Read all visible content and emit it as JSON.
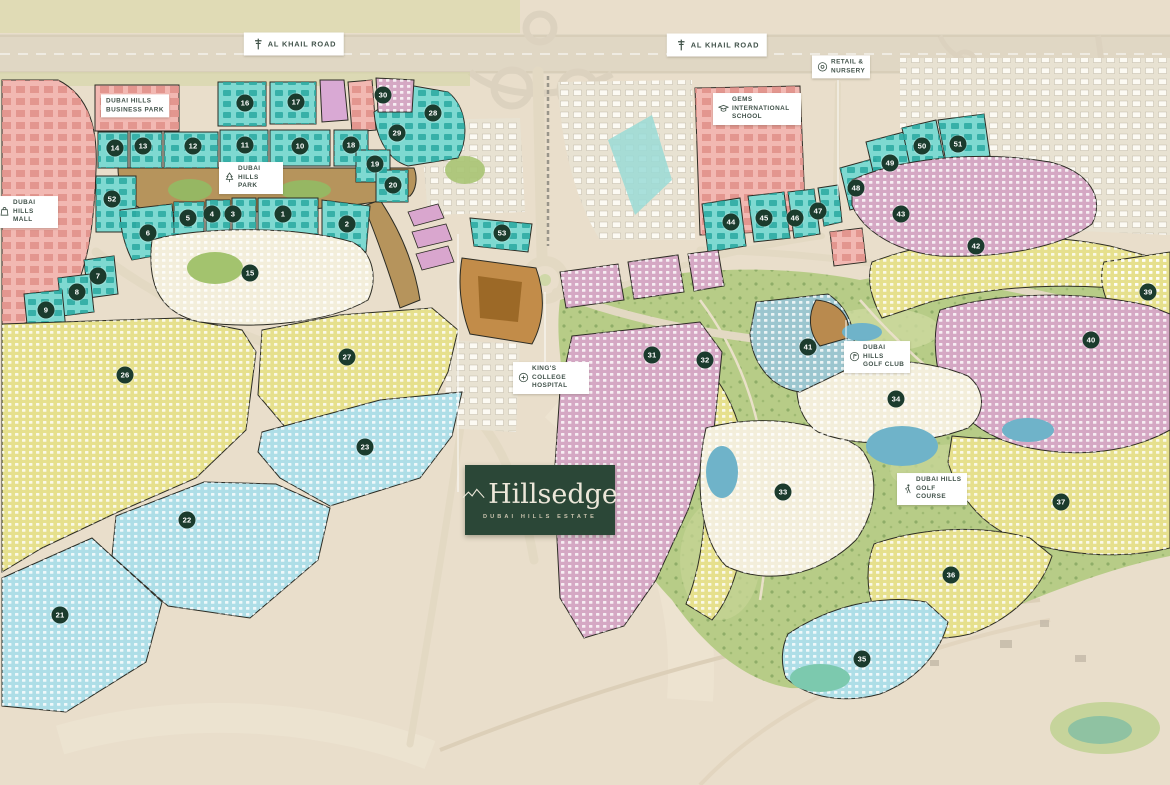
{
  "brand": {
    "name": "Hillsedge",
    "subtitle": "DUBAI HILLS ESTATE"
  },
  "labels": [
    {
      "id": "al-khail-road-west",
      "text": "AL KHAIL ROAD",
      "icon": "road-sign-icon",
      "x": 294,
      "y": 44,
      "big": true
    },
    {
      "id": "al-khail-road-east",
      "text": "AL KHAIL ROAD",
      "icon": "road-sign-icon",
      "x": 717,
      "y": 45,
      "big": true
    },
    {
      "id": "dubai-hills-business-park",
      "text": "DUBAI HILLS BUSINESS PARK",
      "icon": null,
      "x": 135,
      "y": 106,
      "w": 58
    },
    {
      "id": "dubai-hills-mall",
      "text": "DUBAI HILLS MALL",
      "icon": "shopping-bag-icon",
      "x": 26,
      "y": 212,
      "w": 40
    },
    {
      "id": "dubai-hills-park",
      "text": "DUBAI HILLS PARK",
      "icon": "tree-icon",
      "x": 251,
      "y": 178,
      "w": 40
    },
    {
      "id": "gems-international-school",
      "text": "GEMS INTERNATIONAL SCHOOL",
      "icon": "graduation-cap-icon",
      "x": 757,
      "y": 109,
      "w": 64
    },
    {
      "id": "retail-nursery",
      "text": "RETAIL & NURSERY",
      "icon": "retail-icon",
      "x": 841,
      "y": 67,
      "w": 34
    },
    {
      "id": "kings-college-hospital",
      "text": "KING'S COLLEGE HOSPITAL",
      "icon": "medical-cross-icon",
      "x": 551,
      "y": 378,
      "w": 52
    },
    {
      "id": "dubai-hills-golf-club",
      "text": "DUBAI HILLS GOLF CLUB",
      "icon": "golf-flag-icon",
      "x": 877,
      "y": 357,
      "w": 42
    },
    {
      "id": "dubai-hills-golf-course",
      "text": "DUBAI HILLS GOLF COURSE",
      "icon": "golfer-icon",
      "x": 932,
      "y": 489,
      "w": 46
    }
  ],
  "plot_markers": [
    {
      "number": "1",
      "x": 283,
      "y": 214
    },
    {
      "number": "2",
      "x": 347,
      "y": 224
    },
    {
      "number": "3",
      "x": 233,
      "y": 214
    },
    {
      "number": "4",
      "x": 212,
      "y": 214
    },
    {
      "number": "5",
      "x": 188,
      "y": 218
    },
    {
      "number": "6",
      "x": 148,
      "y": 233
    },
    {
      "number": "7",
      "x": 98,
      "y": 276
    },
    {
      "number": "8",
      "x": 77,
      "y": 292
    },
    {
      "number": "9",
      "x": 46,
      "y": 310
    },
    {
      "number": "10",
      "x": 300,
      "y": 146
    },
    {
      "number": "11",
      "x": 245,
      "y": 145
    },
    {
      "number": "12",
      "x": 193,
      "y": 146
    },
    {
      "number": "13",
      "x": 143,
      "y": 146
    },
    {
      "number": "14",
      "x": 115,
      "y": 148
    },
    {
      "number": "15",
      "x": 250,
      "y": 273
    },
    {
      "number": "16",
      "x": 245,
      "y": 103
    },
    {
      "number": "17",
      "x": 296,
      "y": 102
    },
    {
      "number": "18",
      "x": 351,
      "y": 145
    },
    {
      "number": "19",
      "x": 375,
      "y": 164
    },
    {
      "number": "20",
      "x": 393,
      "y": 185
    },
    {
      "number": "21",
      "x": 60,
      "y": 615
    },
    {
      "number": "22",
      "x": 187,
      "y": 520
    },
    {
      "number": "23",
      "x": 365,
      "y": 447
    },
    {
      "number": "26",
      "x": 125,
      "y": 375
    },
    {
      "number": "27",
      "x": 347,
      "y": 357
    },
    {
      "number": "28",
      "x": 433,
      "y": 113
    },
    {
      "number": "29",
      "x": 397,
      "y": 133
    },
    {
      "number": "30",
      "x": 383,
      "y": 95
    },
    {
      "number": "31",
      "x": 652,
      "y": 355
    },
    {
      "number": "32",
      "x": 705,
      "y": 360
    },
    {
      "number": "33",
      "x": 783,
      "y": 492
    },
    {
      "number": "34",
      "x": 896,
      "y": 399
    },
    {
      "number": "35",
      "x": 862,
      "y": 659
    },
    {
      "number": "36",
      "x": 951,
      "y": 575
    },
    {
      "number": "37",
      "x": 1061,
      "y": 502
    },
    {
      "number": "39",
      "x": 1148,
      "y": 292
    },
    {
      "number": "40",
      "x": 1091,
      "y": 340
    },
    {
      "number": "41",
      "x": 808,
      "y": 347
    },
    {
      "number": "42",
      "x": 976,
      "y": 246
    },
    {
      "number": "43",
      "x": 901,
      "y": 214
    },
    {
      "number": "44",
      "x": 731,
      "y": 222
    },
    {
      "number": "45",
      "x": 764,
      "y": 218
    },
    {
      "number": "46",
      "x": 795,
      "y": 218
    },
    {
      "number": "47",
      "x": 818,
      "y": 211
    },
    {
      "number": "48",
      "x": 856,
      "y": 188
    },
    {
      "number": "49",
      "x": 890,
      "y": 163
    },
    {
      "number": "50",
      "x": 922,
      "y": 146
    },
    {
      "number": "51",
      "x": 958,
      "y": 144
    },
    {
      "number": "52",
      "x": 112,
      "y": 199
    },
    {
      "number": "53",
      "x": 502,
      "y": 233
    }
  ],
  "colors": {
    "marker_bg": "#1b3b2d",
    "label_text": "#41524a",
    "logo_bg": "#2b4737",
    "logo_text": "#ece7d9",
    "parcel_teal": "#7ed9d1",
    "parcel_pink": "#f2b8b2",
    "parcel_mauve": "#d5a8c4",
    "parcel_yellow": "#e6e08d",
    "parcel_blue": "#aedee7",
    "parcel_cream": "#f3eedb",
    "golf_green": "#b7cc87",
    "park_brown": "#b6945c",
    "water": "#6fb3c9",
    "desert": "#e9decb"
  }
}
